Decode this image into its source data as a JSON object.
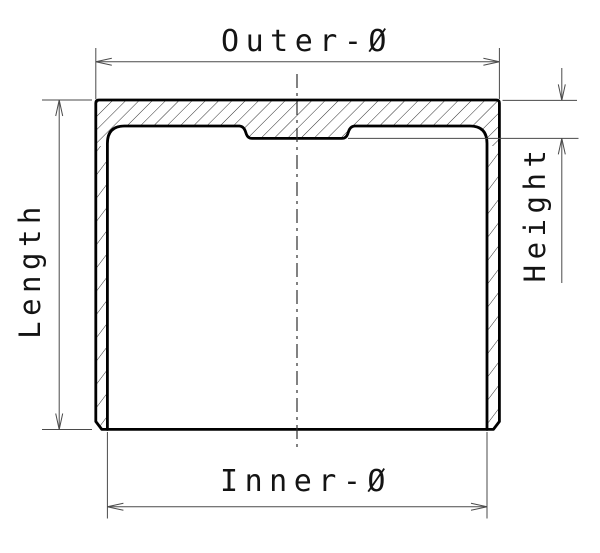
{
  "diagram": {
    "type": "technical-cross-section-drawing",
    "subject": "cylindrical cup (valve tappet) cross-section with dimension callouts",
    "labels": {
      "outer_diameter": "Outer-Ø",
      "inner_diameter": "Inner-Ø",
      "length": "Length",
      "height": "Height"
    },
    "colors": {
      "background": "#ffffff",
      "part_outline": "#000000",
      "hatching": "#2f2f2f",
      "dimension_lines": "#4a4a4a",
      "text": "#141414"
    }
  }
}
